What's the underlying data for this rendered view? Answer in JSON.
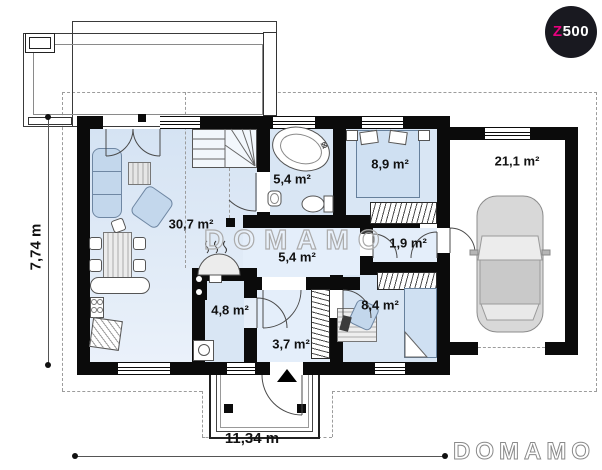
{
  "logo": {
    "prefix": "Z",
    "suffix": "500"
  },
  "watermarks": {
    "center": "DOMAMO",
    "corner": "DOMAMO"
  },
  "dimensions": {
    "horizontal": "11,34 m",
    "vertical": "7,74 m"
  },
  "rooms": {
    "living_room": {
      "area": "30,7 m²"
    },
    "bathroom": {
      "area": "5,4 m²"
    },
    "bedroom": {
      "area": "8,9 m²"
    },
    "garage": {
      "area": "21,1 m²"
    },
    "hallway": {
      "area": "5,4 m²"
    },
    "closet": {
      "area": "1,9 m²"
    },
    "utility_room": {
      "area": "4,8 m²"
    },
    "office": {
      "area": "8,4 m²"
    },
    "vestibule": {
      "area": "3,7 m²"
    }
  },
  "colors": {
    "wall": "#0b0b0b",
    "floor": "#d9e6f4",
    "furniture": "#c3d7ec",
    "logo_accent": "#e6007e",
    "watermark": "#ababab"
  }
}
